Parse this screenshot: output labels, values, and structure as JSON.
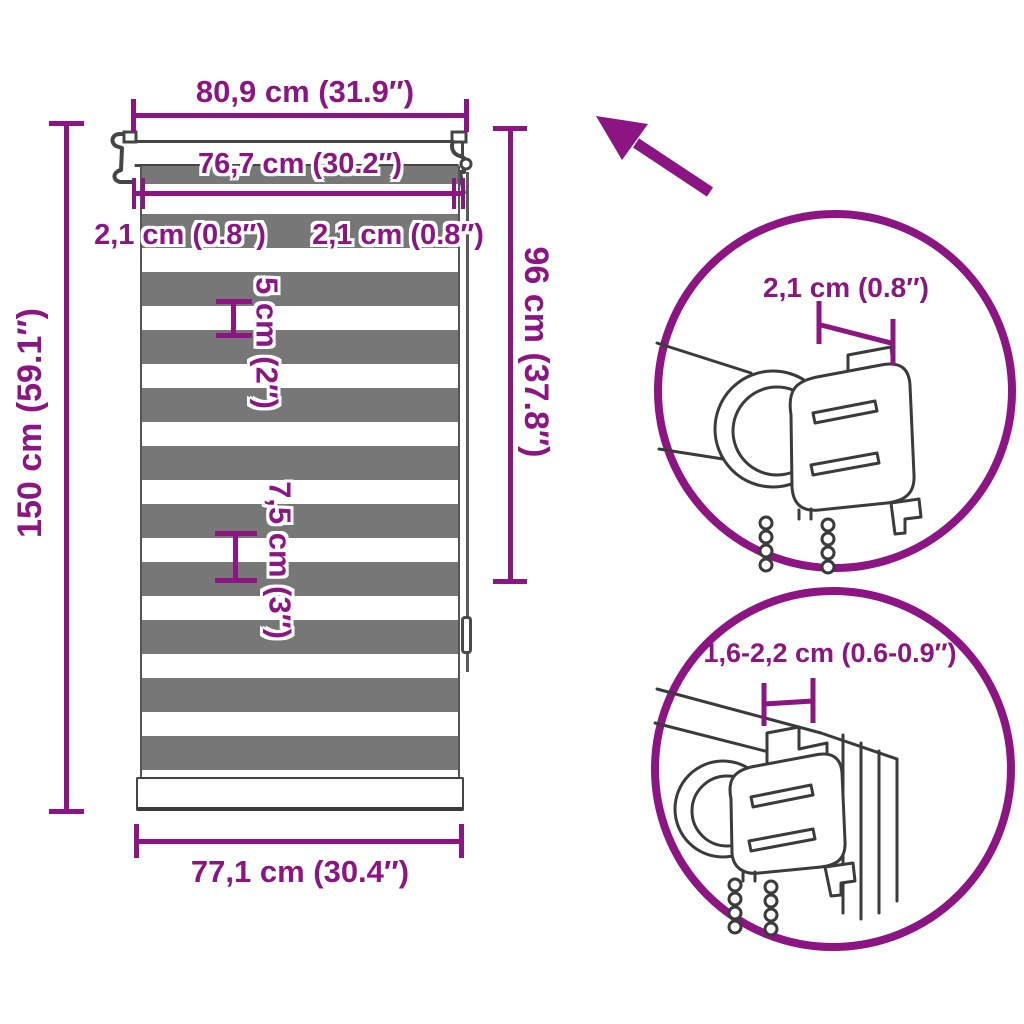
{
  "colors": {
    "accent": "#8c1583",
    "stripe_gray": "#777777",
    "lineart": "#3b3b3b"
  },
  "diagram": {
    "title_role": "zebra roller blind dimension diagram",
    "labels": {
      "top_width": "80,9 cm (31.9″)",
      "inner_width": "76,7 cm (30.2″)",
      "bracket_offset_left": "2,1 cm (0.8″)",
      "bracket_offset_right": "2,1 cm (0.8″)",
      "total_height": "150 cm (59.1″)",
      "fabric_height": "96 cm (37.8″)",
      "white_stripe": "5 cm (2″)",
      "stripe_pair": "7,5 cm (3″)",
      "bottom_width": "77,1 cm (30.4″)",
      "detail_top_circle": "2,1 cm (0.8″)",
      "detail_bottom_circle": "1,6-2,2 cm (0.6-0.9″)"
    },
    "icons": [
      "up-left-arrow",
      "detail-circle-top",
      "detail-circle-bottom"
    ]
  }
}
